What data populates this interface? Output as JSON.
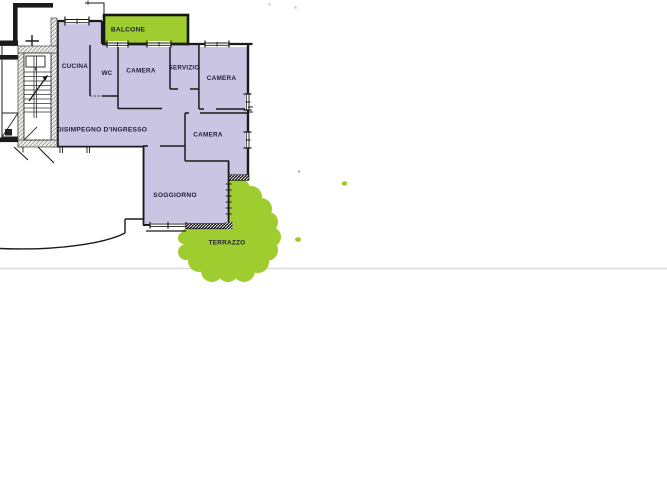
{
  "plan": {
    "kind": "apartment-floor-plan",
    "language": "it",
    "rooms": [
      {
        "id": "balcone",
        "label": "BALCONE",
        "outdoor": true
      },
      {
        "id": "cucina",
        "label": "CUCINA",
        "outdoor": false
      },
      {
        "id": "wc",
        "label": "WC",
        "outdoor": false
      },
      {
        "id": "camera-1",
        "label": "CAMERA",
        "outdoor": false
      },
      {
        "id": "servizio",
        "label": "SERVIZIO",
        "outdoor": false
      },
      {
        "id": "camera-2",
        "label": "CAMERA",
        "outdoor": false
      },
      {
        "id": "disimpegno",
        "label": "DISIMPEGNO D'INGRESSO",
        "outdoor": false
      },
      {
        "id": "camera-3",
        "label": "CAMERA",
        "outdoor": false
      },
      {
        "id": "soggiorno",
        "label": "SOGGIORNO",
        "outdoor": false
      },
      {
        "id": "terrazzo",
        "label": "TERRAZZO",
        "outdoor": true
      }
    ],
    "colors": {
      "apartment_fill": "#cac5e2",
      "outdoor_fill": "#9fcc2e",
      "wall": "#1b1b1b",
      "label_text": "#1d1d3a",
      "page_background": "#ffffff",
      "divider_line": "#dadada"
    }
  }
}
